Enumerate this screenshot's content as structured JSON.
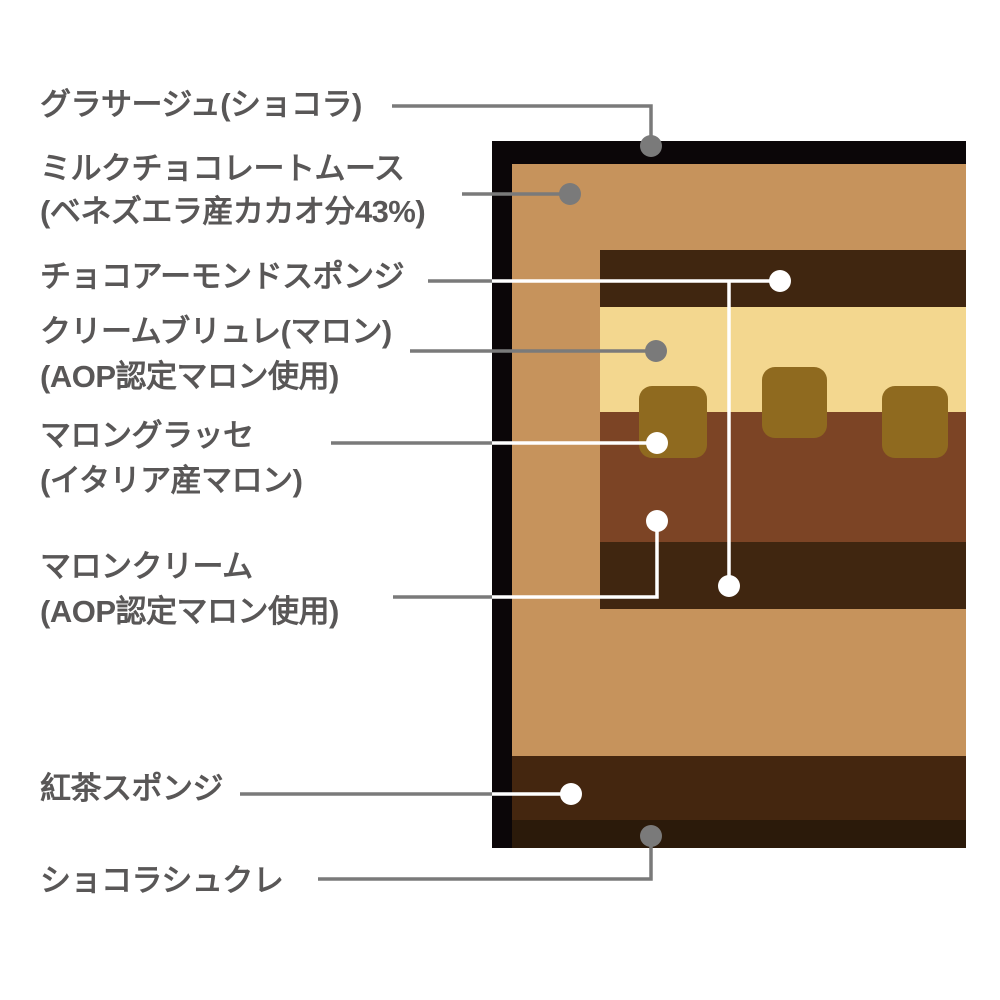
{
  "diagram": {
    "type": "layered-cake-cross-section-callouts",
    "labels": [
      {
        "id": "glacage",
        "lines": [
          "グラサージュ(ショコラ)"
        ]
      },
      {
        "id": "milk-chocolate-mousse",
        "lines": [
          "ミルクチョコレートムース",
          "(ベネズエラ産カカオ分43%)"
        ]
      },
      {
        "id": "choco-almond-sponge",
        "lines": [
          "チョコアーモンドスポンジ"
        ]
      },
      {
        "id": "creme-brulee-marron",
        "lines": [
          "クリームブリュレ(マロン)",
          "(AOP認定マロン使用)"
        ]
      },
      {
        "id": "marron-glace",
        "lines": [
          "マロングラッセ",
          "(イタリア産マロン)"
        ]
      },
      {
        "id": "marron-cream",
        "lines": [
          "マロンクリーム",
          "(AOP認定マロン使用)"
        ]
      },
      {
        "id": "tea-sponge",
        "lines": [
          "紅茶スポンジ"
        ]
      },
      {
        "id": "chocolat-sucre",
        "lines": [
          "ショコラシュクレ"
        ]
      }
    ],
    "colors": {
      "background": "#ffffff",
      "label_text": "#595757",
      "connector_gray": "#7a7a7a",
      "connector_white": "#ffffff",
      "dot_gray": "#7a7a7a",
      "dot_white": "#ffffff",
      "glacage_chocolat": "#0b0608",
      "milk_chocolate_mousse": "#c6935c",
      "choco_almond_sponge": "#402610",
      "creme_brulee": "#f3d78f",
      "marron_glace": "#8f6a1f",
      "marron_cream": "#7c4425",
      "tea_sponge": "#44260f",
      "chocolat_sucre": "#2b1a0a"
    }
  }
}
